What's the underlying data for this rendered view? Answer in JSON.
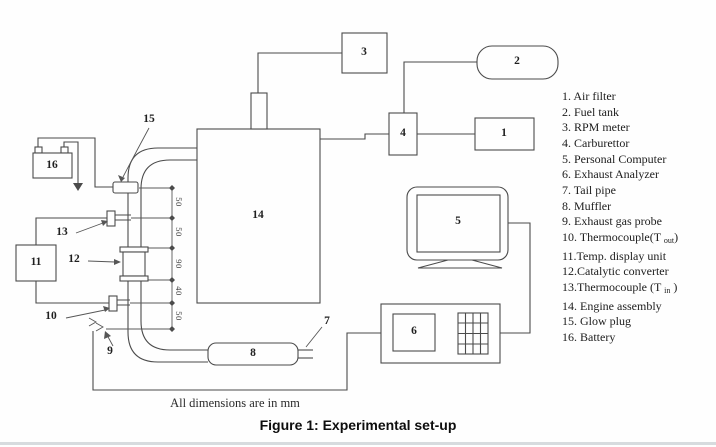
{
  "figure": {
    "note": "All dimensions are in mm",
    "caption": "Figure 1: Experimental set-up"
  },
  "legend": {
    "items": [
      {
        "text": "1. Air filter"
      },
      {
        "text": "2. Fuel tank"
      },
      {
        "text": "3. RPM meter"
      },
      {
        "text": "4. Carburettor"
      },
      {
        "text": "5. Personal Computer"
      },
      {
        "text": "6. Exhaust Analyzer"
      },
      {
        "text": "7. Tail pipe"
      },
      {
        "text": "8. Muffler"
      },
      {
        "text": "9. Exhaust gas probe"
      },
      {
        "pre": "10. Thermocouple(T ",
        "sub": "out",
        "post": ")"
      },
      {
        "text": "11.Temp. display unit"
      },
      {
        "text": "12.Catalytic converter"
      },
      {
        "pre": "13.Thermocouple (T ",
        "sub": "in",
        "post": " )"
      },
      {
        "text": "14. Engine assembly"
      },
      {
        "text": "15. Glow plug"
      },
      {
        "text": "16. Battery"
      }
    ]
  },
  "diagram": {
    "component_numbers": {
      "air_filter": "1",
      "fuel_tank": "2",
      "rpm_meter": "3",
      "carburettor": "4",
      "personal_computer": "5",
      "exhaust_analyzer": "6",
      "tail_pipe": "7",
      "muffler": "8",
      "exhaust_gas_probe": "9",
      "thermocouple_out": "10",
      "temp_display_unit": "11",
      "catalytic_converter": "12",
      "thermocouple_in": "13",
      "engine_assembly": "14",
      "glow_plug": "15",
      "battery": "16"
    },
    "pipe_dimensions_mm": [
      "50",
      "50",
      "90",
      "40",
      "50"
    ]
  },
  "colors": {
    "line": "#4b4b4b",
    "text": "#1f1f1f"
  }
}
